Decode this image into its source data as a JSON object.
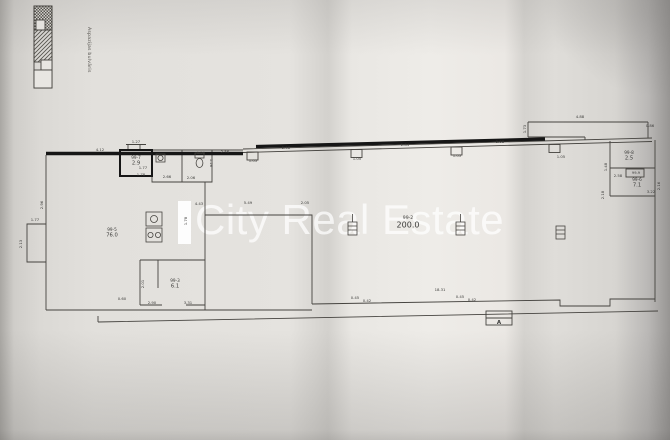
{
  "street_label": "Aspazijas bulvāris",
  "watermark": {
    "text": "City Real Estate",
    "color": "#ffffff"
  },
  "colors": {
    "ink": "#3f3f3d",
    "heavy_ink": "#161616",
    "paper": "#e5e3df"
  },
  "plan": {
    "rooms": [
      {
        "id": "99-7",
        "area": "2.9",
        "x": 136,
        "y": 159,
        "big": false
      },
      {
        "id": "99-5",
        "area": "76.0",
        "x": 112,
        "y": 231,
        "big": false
      },
      {
        "id": "99-3",
        "area": "6.1",
        "x": 175,
        "y": 282,
        "big": false
      },
      {
        "id": "99-2",
        "area": "200.0",
        "x": 408,
        "y": 219,
        "big": true
      },
      {
        "id": "99-8",
        "area": "2.5",
        "x": 629,
        "y": 154,
        "big": false
      },
      {
        "id": "99-6",
        "area": "7.1",
        "x": 637,
        "y": 181,
        "big": false
      }
    ],
    "boxed_label": {
      "text": "99-9",
      "x": 636,
      "y": 174
    },
    "section_marker": {
      "text": "A",
      "x": 499,
      "y": 324
    },
    "dimensions": [
      {
        "t": "4.12",
        "x": 100,
        "y": 151,
        "r": 0
      },
      {
        "t": "1.27",
        "x": 136,
        "y": 143,
        "r": 0
      },
      {
        "t": "1.77",
        "x": 143,
        "y": 169,
        "r": 0
      },
      {
        "t": "1.78",
        "x": 141,
        "y": 176,
        "r": 0
      },
      {
        "t": "2.66",
        "x": 167,
        "y": 178,
        "r": 0
      },
      {
        "t": "2.06",
        "x": 191,
        "y": 179,
        "r": 0
      },
      {
        "t": "1.29",
        "x": 201,
        "y": 154,
        "r": 0
      },
      {
        "t": "1.26",
        "x": 210,
        "y": 163,
        "r": 90
      },
      {
        "t": "2.96",
        "x": 43,
        "y": 205,
        "r": -90
      },
      {
        "t": "1.77",
        "x": 35,
        "y": 221,
        "r": 0
      },
      {
        "t": "2.13",
        "x": 22,
        "y": 244,
        "r": -90
      },
      {
        "t": "0.60",
        "x": 122,
        "y": 300,
        "r": 0
      },
      {
        "t": "2.90",
        "x": 152,
        "y": 304,
        "r": 0
      },
      {
        "t": "3.31",
        "x": 188,
        "y": 304,
        "r": 0
      },
      {
        "t": "2.01",
        "x": 144,
        "y": 284,
        "r": -90
      },
      {
        "t": "4.43",
        "x": 199,
        "y": 205,
        "r": 0
      },
      {
        "t": "5.49",
        "x": 248,
        "y": 204,
        "r": 0
      },
      {
        "t": "2.05",
        "x": 305,
        "y": 204,
        "r": 0
      },
      {
        "t": "1.78",
        "x": 187,
        "y": 221,
        "r": -90
      },
      {
        "t": "2.56",
        "x": 225,
        "y": 153,
        "r": 0
      },
      {
        "t": "2.98",
        "x": 286,
        "y": 149,
        "r": 0
      },
      {
        "t": "1.05",
        "x": 253,
        "y": 162,
        "r": 0
      },
      {
        "t": "2.84",
        "x": 405,
        "y": 146,
        "r": 0
      },
      {
        "t": "1.05",
        "x": 357,
        "y": 160,
        "r": 0
      },
      {
        "t": "2.98",
        "x": 500,
        "y": 143,
        "r": 0
      },
      {
        "t": "1.05",
        "x": 457,
        "y": 157,
        "r": 0
      },
      {
        "t": "1.73",
        "x": 526,
        "y": 129,
        "r": -90
      },
      {
        "t": "4.88",
        "x": 580,
        "y": 118,
        "r": 0
      },
      {
        "t": "0.86",
        "x": 650,
        "y": 127,
        "r": 0
      },
      {
        "t": "1.05",
        "x": 561,
        "y": 158,
        "r": 0
      },
      {
        "t": "1.48",
        "x": 607,
        "y": 167,
        "r": -90
      },
      {
        "t": "2.58",
        "x": 618,
        "y": 177,
        "r": 0
      },
      {
        "t": "2.16",
        "x": 660,
        "y": 186,
        "r": -90
      },
      {
        "t": "3.22",
        "x": 651,
        "y": 193,
        "r": 0
      },
      {
        "t": "2.18",
        "x": 604,
        "y": 195,
        "r": -90
      },
      {
        "t": "18.31",
        "x": 440,
        "y": 291,
        "r": 0
      },
      {
        "t": "0.45",
        "x": 355,
        "y": 299,
        "r": 0
      },
      {
        "t": "0.42",
        "x": 367,
        "y": 302,
        "r": 0
      },
      {
        "t": "0.45",
        "x": 460,
        "y": 298,
        "r": 0
      },
      {
        "t": "0.42",
        "x": 472,
        "y": 301,
        "r": 0
      }
    ]
  }
}
